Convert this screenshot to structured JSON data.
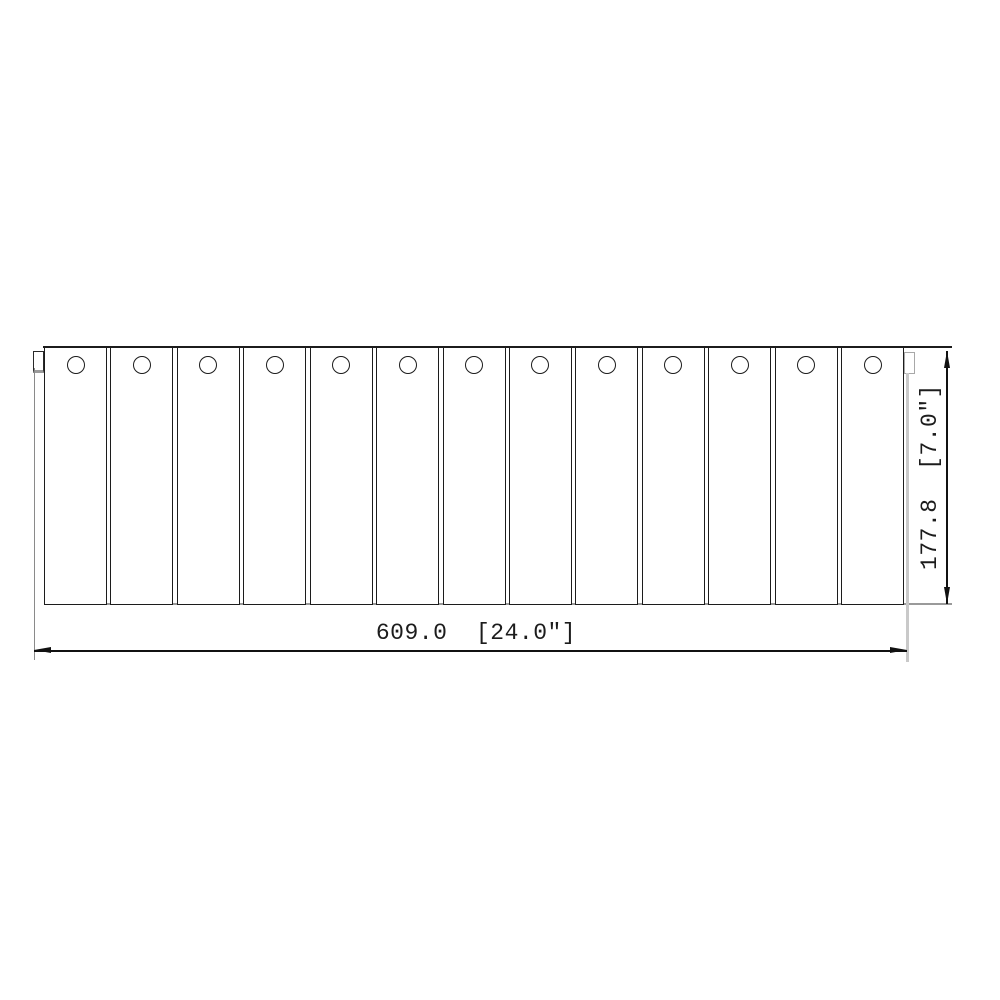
{
  "dimensions": {
    "width_label": "609.0  [24.0\"]",
    "height_label": "177.8  [7.0\"]"
  },
  "panel": {
    "slat_count": 13,
    "holes_per_slat": 1
  },
  "colors": {
    "background": "#ffffff",
    "line_dark": "#1c1c1c",
    "line_gray": "#9a9a9a",
    "line_light": "#c9c9c9",
    "dimension_line": "#111111"
  }
}
